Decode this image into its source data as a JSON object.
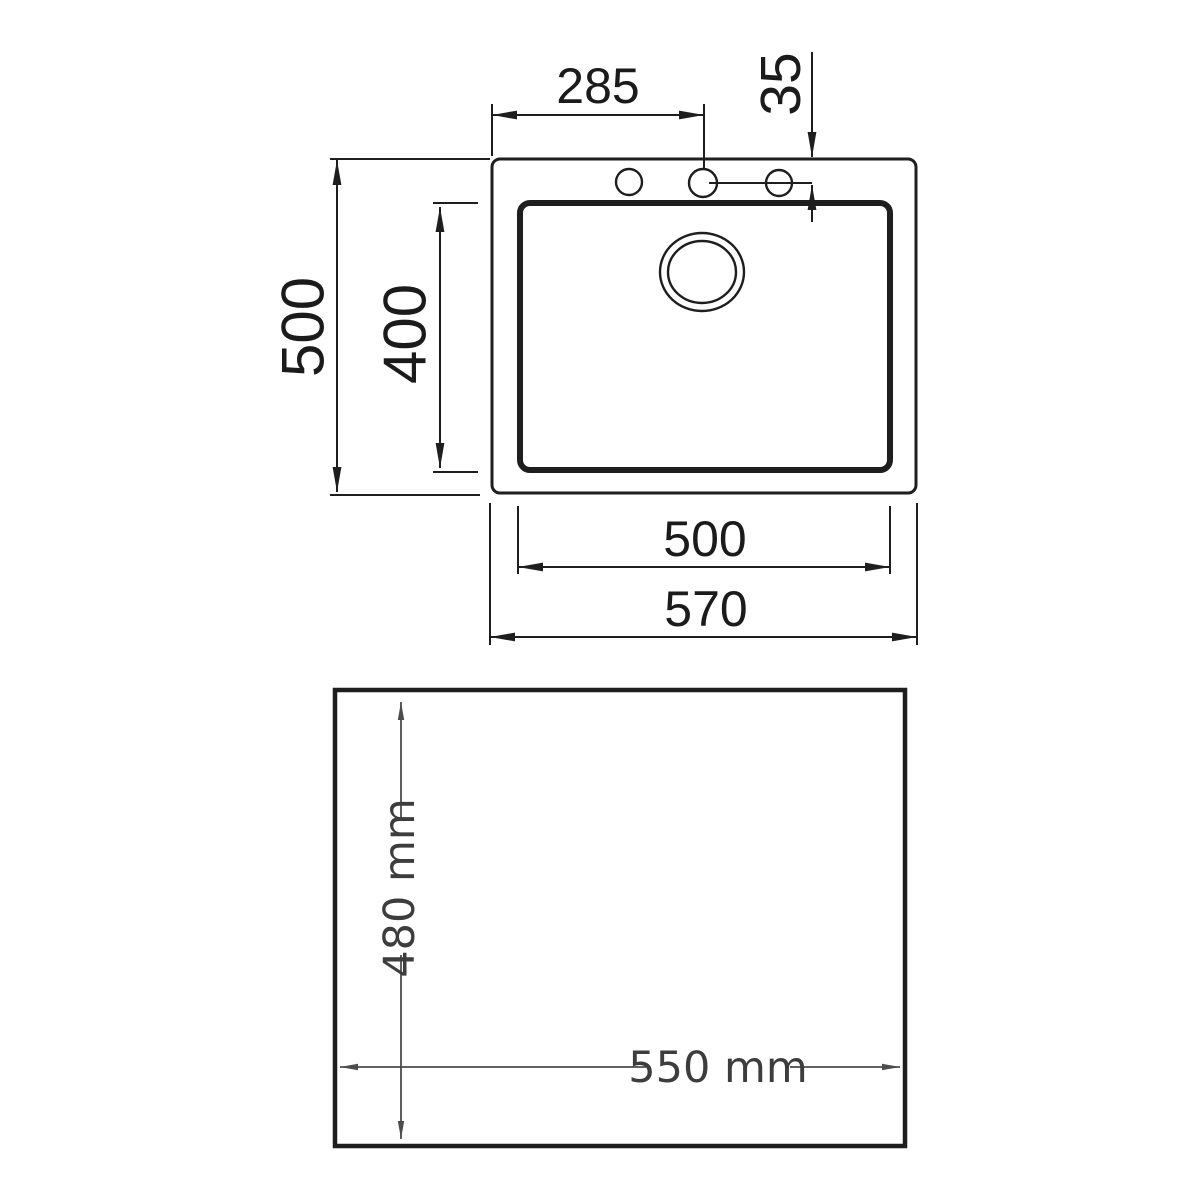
{
  "figure": {
    "title": "sink-dimension-drawing",
    "line_color": "#1e1e1e",
    "secondary_line_color": "#4c4c4c",
    "text_color_top": "#1b1b1b",
    "text_color_bottom": "#3d3d3d",
    "background": "#ffffff"
  },
  "sink_top_view": {
    "dim_faucet_hole_span": "285",
    "dim_hole_offset": "35",
    "dim_overall_depth": "500",
    "dim_bowl_depth": "400",
    "dim_bowl_width": "500",
    "dim_overall_width": "570"
  },
  "cutout_view": {
    "dim_cutout_depth": "480 mm",
    "dim_cutout_width": "550 mm"
  }
}
